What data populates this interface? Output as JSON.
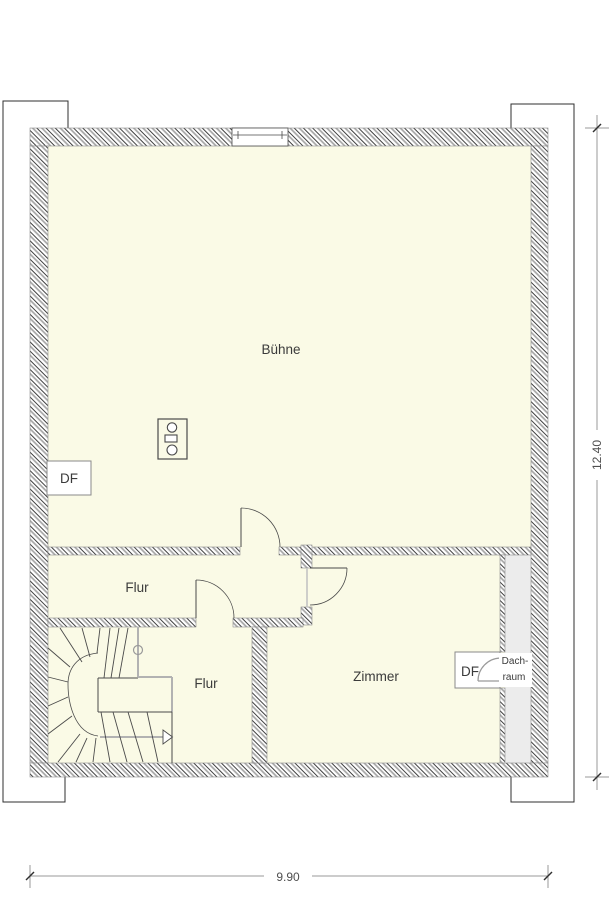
{
  "rooms": {
    "buehne": "Bühne",
    "flur_middle": "Flur",
    "flur_lower": "Flur",
    "zimmer": "Zimmer"
  },
  "labels": {
    "df_left": "DF",
    "df_right": "DF",
    "dachraum_line1": "Dach-",
    "dachraum_line2": "raum"
  },
  "dimensions": {
    "width_label": "9.90",
    "height_label": "12.40"
  },
  "colors": {
    "room_fill": "#fafae6",
    "dachraum_fill": "#ececec",
    "wall_edge": "#8a8a8a",
    "roof_line": "#2f2f2f",
    "draw_line": "#4a4a4a",
    "guide_gray": "#b2b2b2",
    "dim_gray": "#999999",
    "dim_text": "#4f4f4f",
    "text_color": "#3b3b3b",
    "hatch_dark": "#3f3f3f",
    "hatch_gray": "#a6a6a6"
  }
}
